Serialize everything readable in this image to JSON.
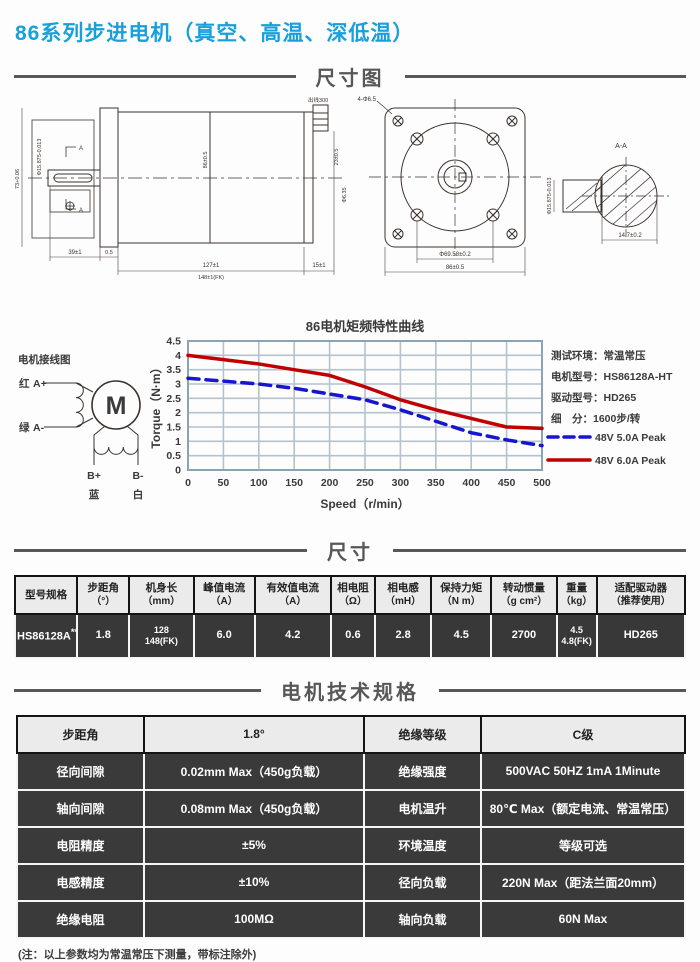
{
  "colors": {
    "title_accent": "#18a0dc",
    "curve_red": "#c00000",
    "curve_blue": "#1616cf",
    "grid": "#b3c2cf",
    "frame": "#8aa4b6",
    "dark_row_bg": "#383838",
    "header_row_bg": "#ebebeb"
  },
  "header": {
    "title": "86系列步进电机（真空、高温、深低温）"
  },
  "sections": {
    "dim_diagram": "尺寸图",
    "size": "尺寸",
    "spec": "电机技术规格"
  },
  "drawing": {
    "side": {
      "wire_label": "出线300",
      "dim_shaft_len": "39±1",
      "dim_gap": "0.5",
      "dim_body_len": "127±1",
      "dim_body_len_fk": "148±1(FK)",
      "dim_rear": "15±1",
      "dim_left_v": "73+0.06",
      "dim_shaft_dia": "Φ15.875-0.013",
      "dim_body_v": "86±0.5",
      "dim_rear_v1": "23±0.5",
      "dim_rear_v2": "Φ6.35",
      "section_mark_top": "A",
      "section_mark_bottom": "A"
    },
    "front": {
      "hole_label": "4-Φ6.5",
      "dim_pilot": "Φ69.58±0.2",
      "dim_flange": "86±0.5"
    },
    "section": {
      "label": "A-A",
      "dim_flat": "14.7±0.2",
      "dim_dia": "Φ15.875-0.013"
    }
  },
  "wiring": {
    "title": "电机接线图",
    "red": "红",
    "a_plus": "A+",
    "green": "绿",
    "a_minus": "A-",
    "b_plus": "B+",
    "b_minus": "B-",
    "blue": "蓝",
    "white": "白",
    "motor": "M"
  },
  "chart_data": {
    "type": "line",
    "title": "86电机矩频特性曲线",
    "xlabel": "Speed（r/min）",
    "ylabel": "Torque（N·m）",
    "x": [
      0,
      50,
      100,
      150,
      200,
      250,
      300,
      350,
      400,
      450,
      500
    ],
    "series": [
      {
        "name": "48V 5.0A Peak",
        "color": "#1616cf",
        "dash": true,
        "values": [
          3.2,
          3.1,
          3.0,
          2.85,
          2.65,
          2.45,
          2.1,
          1.7,
          1.3,
          1.05,
          0.85
        ]
      },
      {
        "name": "48V 6.0A Peak",
        "color": "#c00000",
        "dash": false,
        "values": [
          4.0,
          3.85,
          3.7,
          3.5,
          3.3,
          2.9,
          2.45,
          2.1,
          1.8,
          1.5,
          1.45
        ]
      }
    ],
    "ylim": [
      0,
      4.5
    ],
    "xlim": [
      0,
      500
    ],
    "yticks": [
      0,
      0.5,
      1,
      1.5,
      2,
      2.5,
      3,
      3.5,
      4,
      4.5
    ],
    "ytick_labels": [
      "0",
      "0.5",
      "1",
      "1.5",
      "2",
      "2.5",
      "3",
      "3.5",
      "4",
      "4.5"
    ],
    "grid": true,
    "legend_position": "right",
    "info_lines": [
      "测试环境：常温常压",
      "电机型号：HS86128A-HT",
      "驱动型号：HD265",
      "细　分：1600步/转"
    ]
  },
  "size_table": {
    "headers": [
      {
        "l1": "型号规格",
        "l2": ""
      },
      {
        "l1": "步距角",
        "l2": "（°）"
      },
      {
        "l1": "机身长",
        "l2": "（mm）"
      },
      {
        "l1": "峰值电流",
        "l2": "（A）"
      },
      {
        "l1": "有效值电流",
        "l2": "（A）"
      },
      {
        "l1": "相电阻",
        "l2": "（Ω）"
      },
      {
        "l1": "相电感",
        "l2": "（mH）"
      },
      {
        "l1": "保持力矩",
        "l2": "（N m）"
      },
      {
        "l1": "转动惯量",
        "l2": "（g cm²）"
      },
      {
        "l1": "重量",
        "l2": "（kg）"
      },
      {
        "l1": "适配驱动器",
        "l2": "（推荐使用）"
      }
    ],
    "row": {
      "model": "HS86128A",
      "model_sup": "**",
      "step_angle": "1.8",
      "length_l1": "128",
      "length_l2": "148(FK)",
      "peak_current": "6.0",
      "rms_current": "4.2",
      "resistance": "0.6",
      "inductance": "2.8",
      "holding_torque": "4.5",
      "inertia": "2700",
      "weight_l1": "4.5",
      "weight_l2": "4.8(FK)",
      "driver": "HD265"
    }
  },
  "spec_table": {
    "rows": [
      {
        "c1": "步距角",
        "c2": "1.8°",
        "c3": "绝缘等级",
        "c4": "C级"
      },
      {
        "c1": "径向间隙",
        "c2": "0.02mm Max（450g负载）",
        "c3": "绝缘强度",
        "c4": "500VAC 50HZ 1mA 1Minute"
      },
      {
        "c1": "轴向间隙",
        "c2": "0.08mm Max（450g负载）",
        "c3": "电机温升",
        "c4": "80℃ Max（额定电流、常温常压）"
      },
      {
        "c1": "电阻精度",
        "c2": "±5%",
        "c3": "环境温度",
        "c4": "等级可选"
      },
      {
        "c1": "电感精度",
        "c2": "±10%",
        "c3": "径向负载",
        "c4": "220N Max（距法兰面20mm）"
      },
      {
        "c1": "绝缘电阻",
        "c2": "100MΩ",
        "c3": "轴向负载",
        "c4": "60N  Max"
      }
    ]
  },
  "footer": {
    "note": "(注：以上参数均为常温常压下测量，带标注除外)"
  }
}
